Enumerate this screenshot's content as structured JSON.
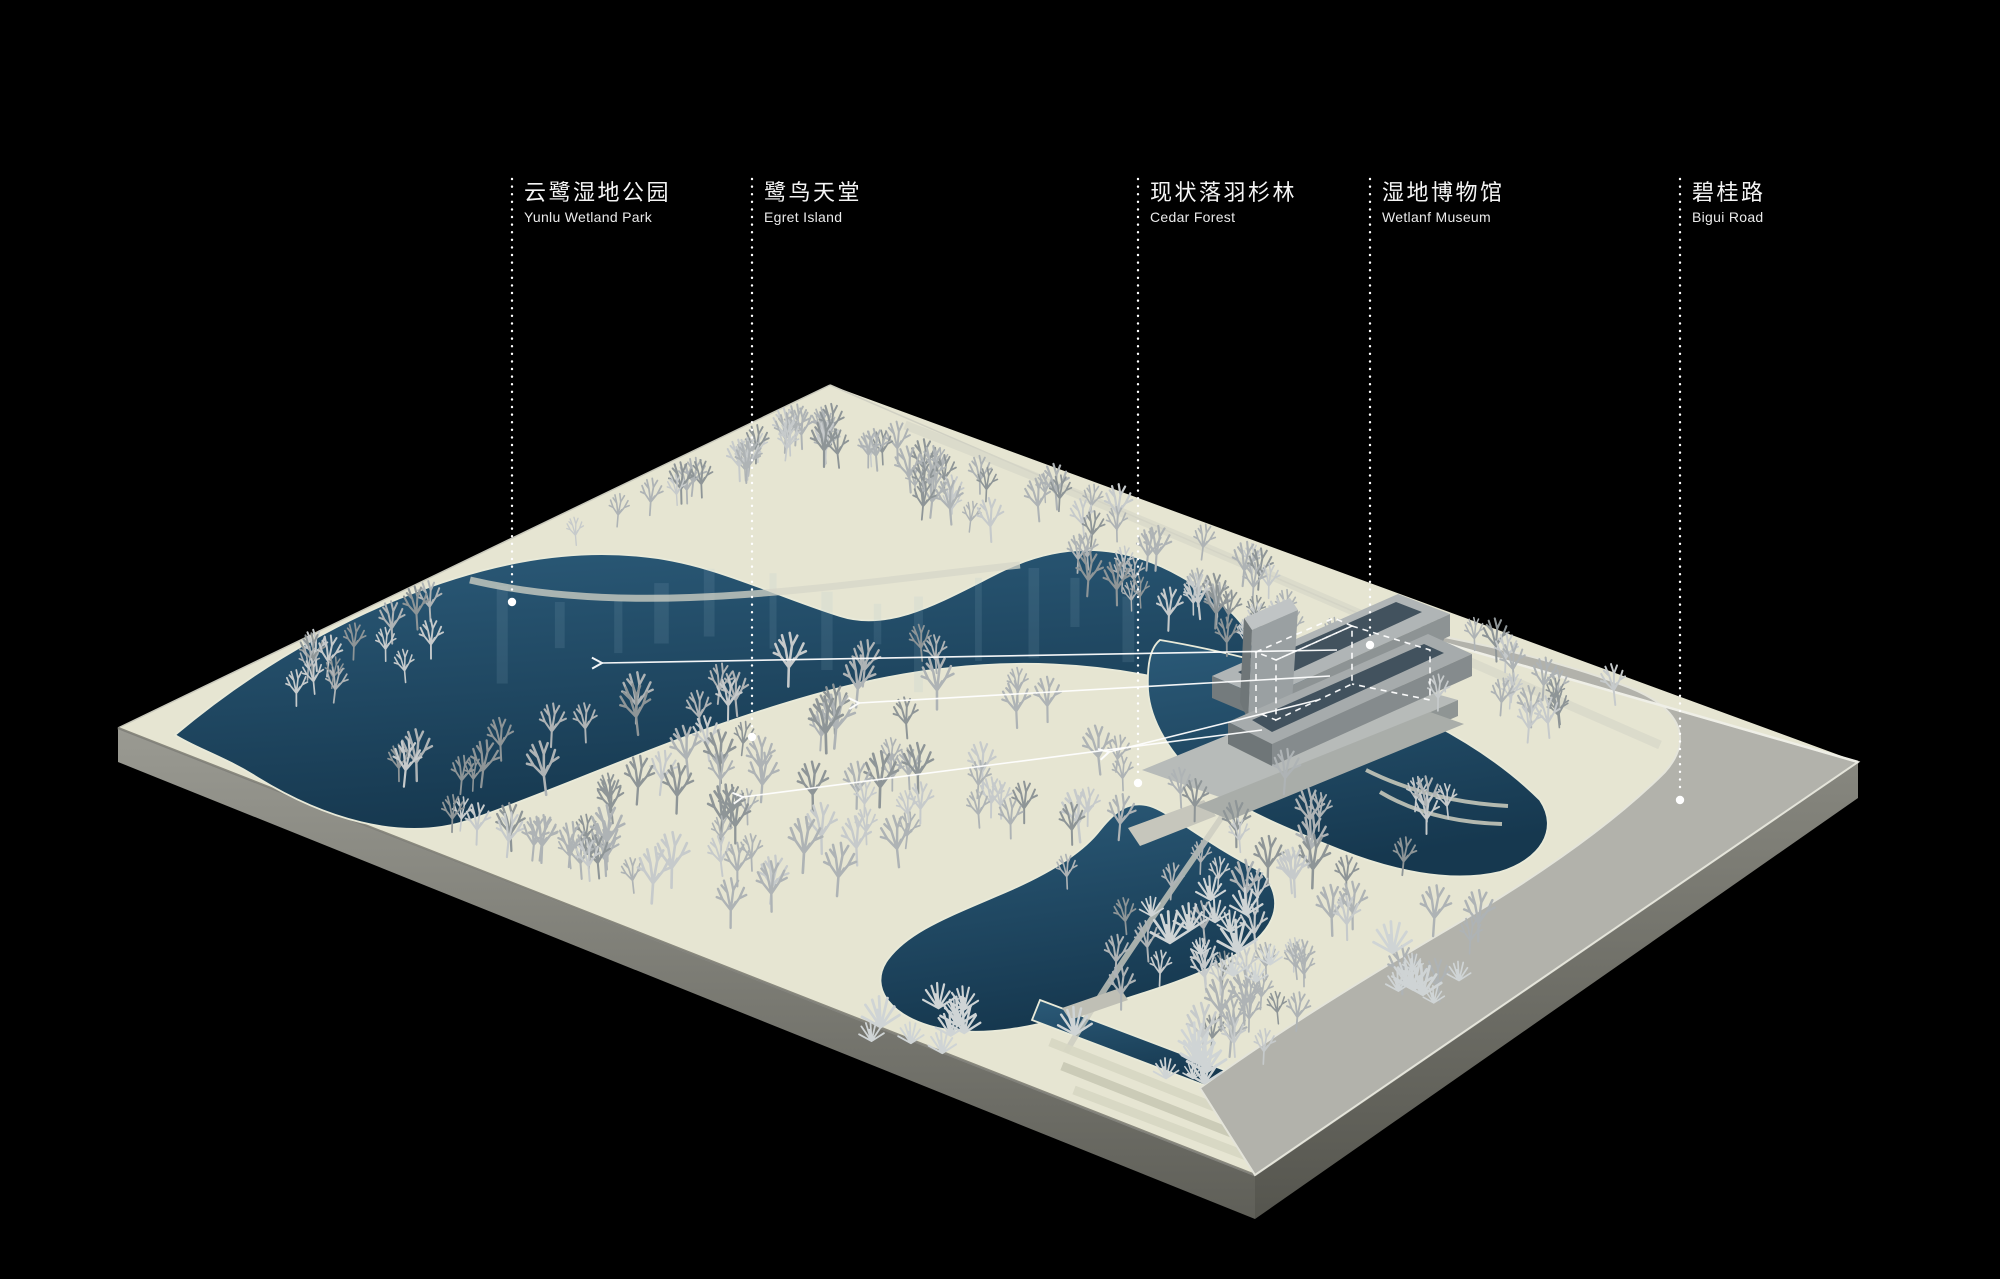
{
  "page": {
    "width": 2000,
    "height": 1279,
    "background": "#000000"
  },
  "annotation": {
    "label_top": 181,
    "labels": [
      {
        "id": "yunlu-wetland-park",
        "zh": "云鹭湿地公园",
        "en": "Yunlu Wetland Park",
        "x": 512,
        "line_end_y": 602
      },
      {
        "id": "egret-island",
        "zh": "鹭鸟天堂",
        "en": "Egret Island",
        "x": 752,
        "line_end_y": 737
      },
      {
        "id": "cedar-forest",
        "zh": "现状落羽杉林",
        "en": "Cedar Forest",
        "x": 1138,
        "line_end_y": 783
      },
      {
        "id": "wetland-museum",
        "zh": "湿地博物馆",
        "en": "Wetlanf Museum",
        "x": 1370,
        "line_end_y": 645
      },
      {
        "id": "bigui-road",
        "zh": "碧桂路",
        "en": "Bigui Road",
        "x": 1680,
        "line_end_y": 800
      }
    ],
    "leader_arrows": [
      {
        "x1": 1337,
        "y1": 650,
        "x2": 602,
        "y2": 663
      },
      {
        "x1": 1330,
        "y1": 676,
        "x2": 859,
        "y2": 703
      },
      {
        "x1": 1318,
        "y1": 700,
        "x2": 1109,
        "y2": 752
      },
      {
        "x1": 1262,
        "y1": 730,
        "x2": 743,
        "y2": 797
      }
    ]
  },
  "colors": {
    "background": "#000000",
    "label_text": "#f5f5f5",
    "annotation_line": "#ffffff",
    "terrain": "#e6e5d2",
    "terrain_shadow": "#cfcfba",
    "water_deep": "#16384f",
    "water_light": "#2b5a78",
    "water_edge": "#e9ead9",
    "road": "#b2b2ab",
    "road_light": "#bcbcb4",
    "board_side_light": "#9a9a92",
    "board_side_dark": "#5f5f58",
    "walkway": "#d6d6c8",
    "tree_light": "#c6cacb",
    "tree_mid": "#aeb3b5",
    "tree_dark": "#8e9597",
    "building_light": "#b7bbb9",
    "building_mid": "#9aa0a2",
    "building_dark": "#6f7678",
    "building_roof": "#42525e"
  }
}
